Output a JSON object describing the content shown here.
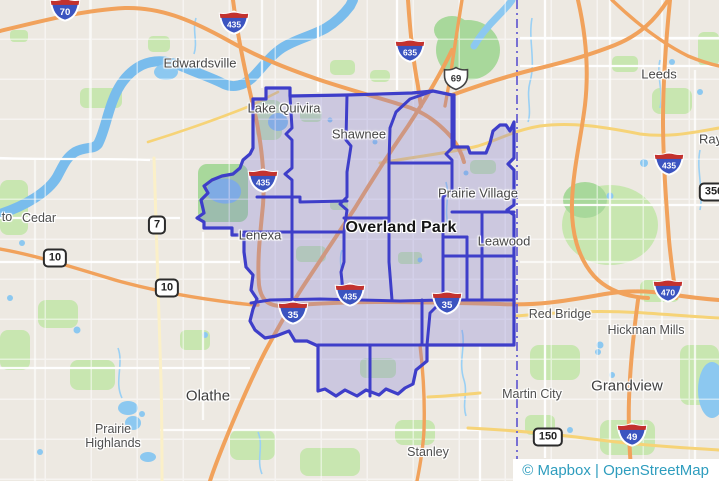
{
  "attribution": {
    "text": "© Mapbox | OpenStreetMap"
  },
  "labels": {
    "edwardsville": "Edwardsville",
    "lake_quivira": "Lake Quivira",
    "shawnee": "Shawnee",
    "prairie_village": "Prairie Village",
    "lenexa": "Lenexa",
    "overland_park": "Overland Park",
    "leawood": "Leawood",
    "leeds": "Leeds",
    "raytown": "Raytown",
    "cedar": "Cedar",
    "de_soto_partial": "to",
    "red_bridge": "Red Bridge",
    "hickman_mills": "Hickman Mills",
    "martin_city": "Martin City",
    "grandview": "Grandview",
    "olathe": "Olathe",
    "prairie_highlands": "Prairie Highlands",
    "stanley": "Stanley"
  },
  "shields": {
    "i70": "70",
    "i435_nw": "435",
    "i635": "635",
    "us69": "69",
    "i435_w": "435",
    "i435_e": "435",
    "mo350": "350",
    "k7": "7",
    "k10_a": "10",
    "k10_b": "10",
    "i435_s": "435",
    "i35_sw": "35",
    "i35_se": "35",
    "i470": "470",
    "mo150": "150",
    "i49": "49"
  },
  "colors": {
    "land": "#EDE9E2",
    "park_green": "#C8E6B0",
    "water": "#8CC8F0",
    "highway_orange": "#F1A25C",
    "road_yellow": "#F6D377",
    "overlay_fill": "#817ED8",
    "overlay_border": "#3E3EC9",
    "state_boundary": "#6A63D2",
    "interstate_blue": "#3B54C0",
    "interstate_red": "#C3322E",
    "attribution_text": "#2E9DBE"
  }
}
